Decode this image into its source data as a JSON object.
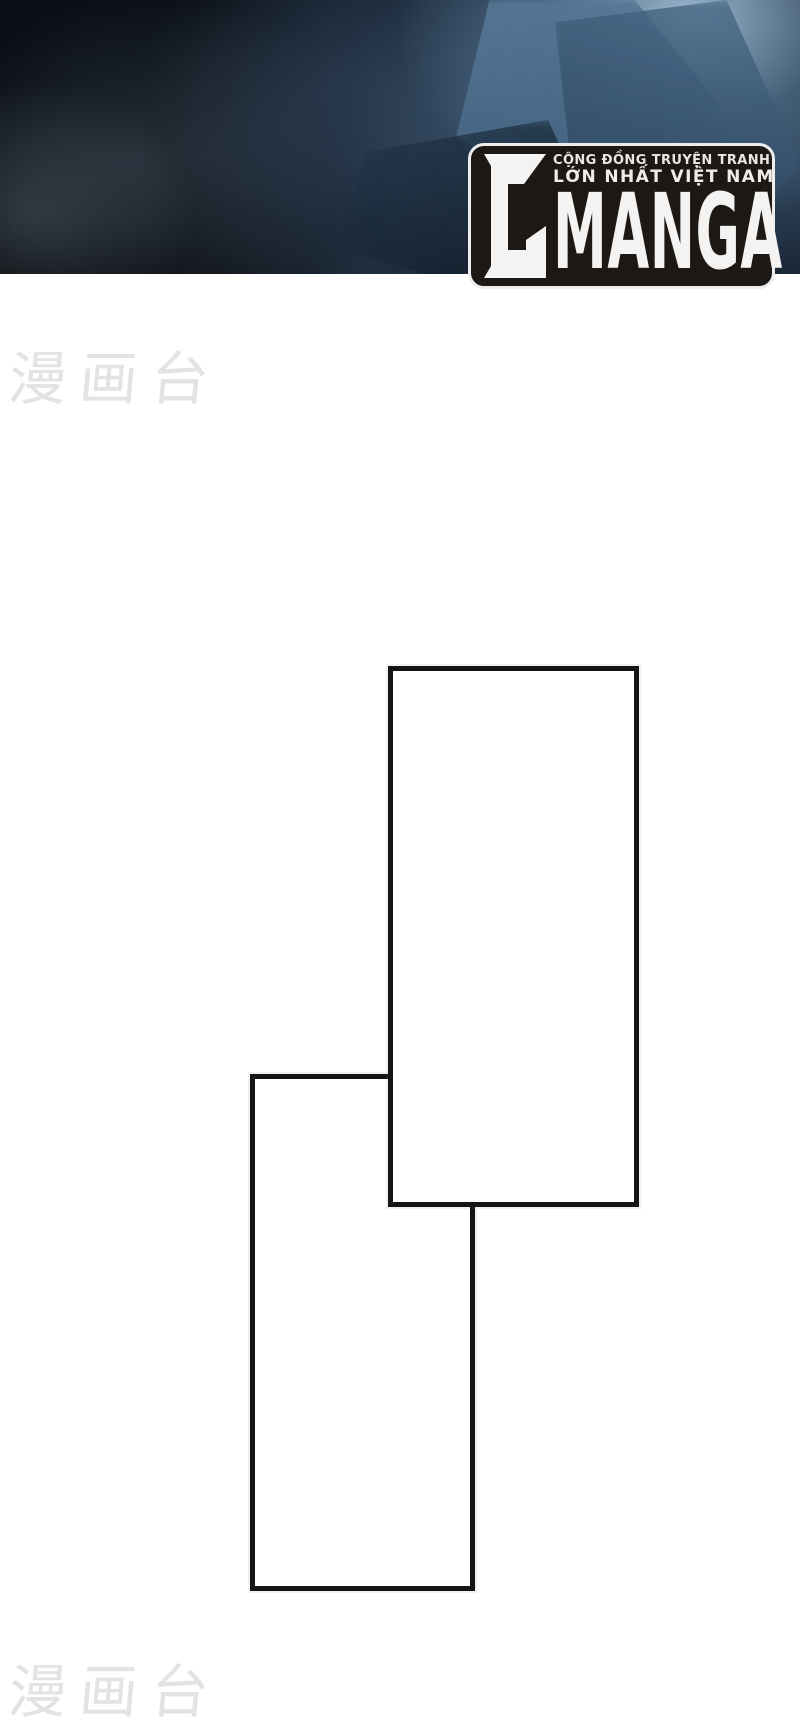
{
  "page": {
    "background_color": "#ffffff",
    "kind": "manga reader page scan"
  },
  "banner": {
    "base_color": "#06090d",
    "cloud_colors": [
      "#5c7e9d",
      "#4a6c8a",
      "#31506e",
      "#22384f",
      "#a0bed6"
    ]
  },
  "logo": {
    "monogram": "C",
    "brand": "MANGA",
    "tagline_line1": "CỘNG ĐỒNG TRUYỆN TRANH",
    "tagline_line2": "LỚN NHẤT VIỆT NAM",
    "box_color": "#1b1815",
    "outline_color": "#ededed",
    "text_color": "#f5f3f1"
  },
  "watermarks": {
    "top": "漫画台",
    "bottom": "漫画台",
    "color": "#e4e2e3"
  },
  "panels": {
    "border_color": "#151515",
    "fill_color": "#ffffff",
    "count": 2
  }
}
